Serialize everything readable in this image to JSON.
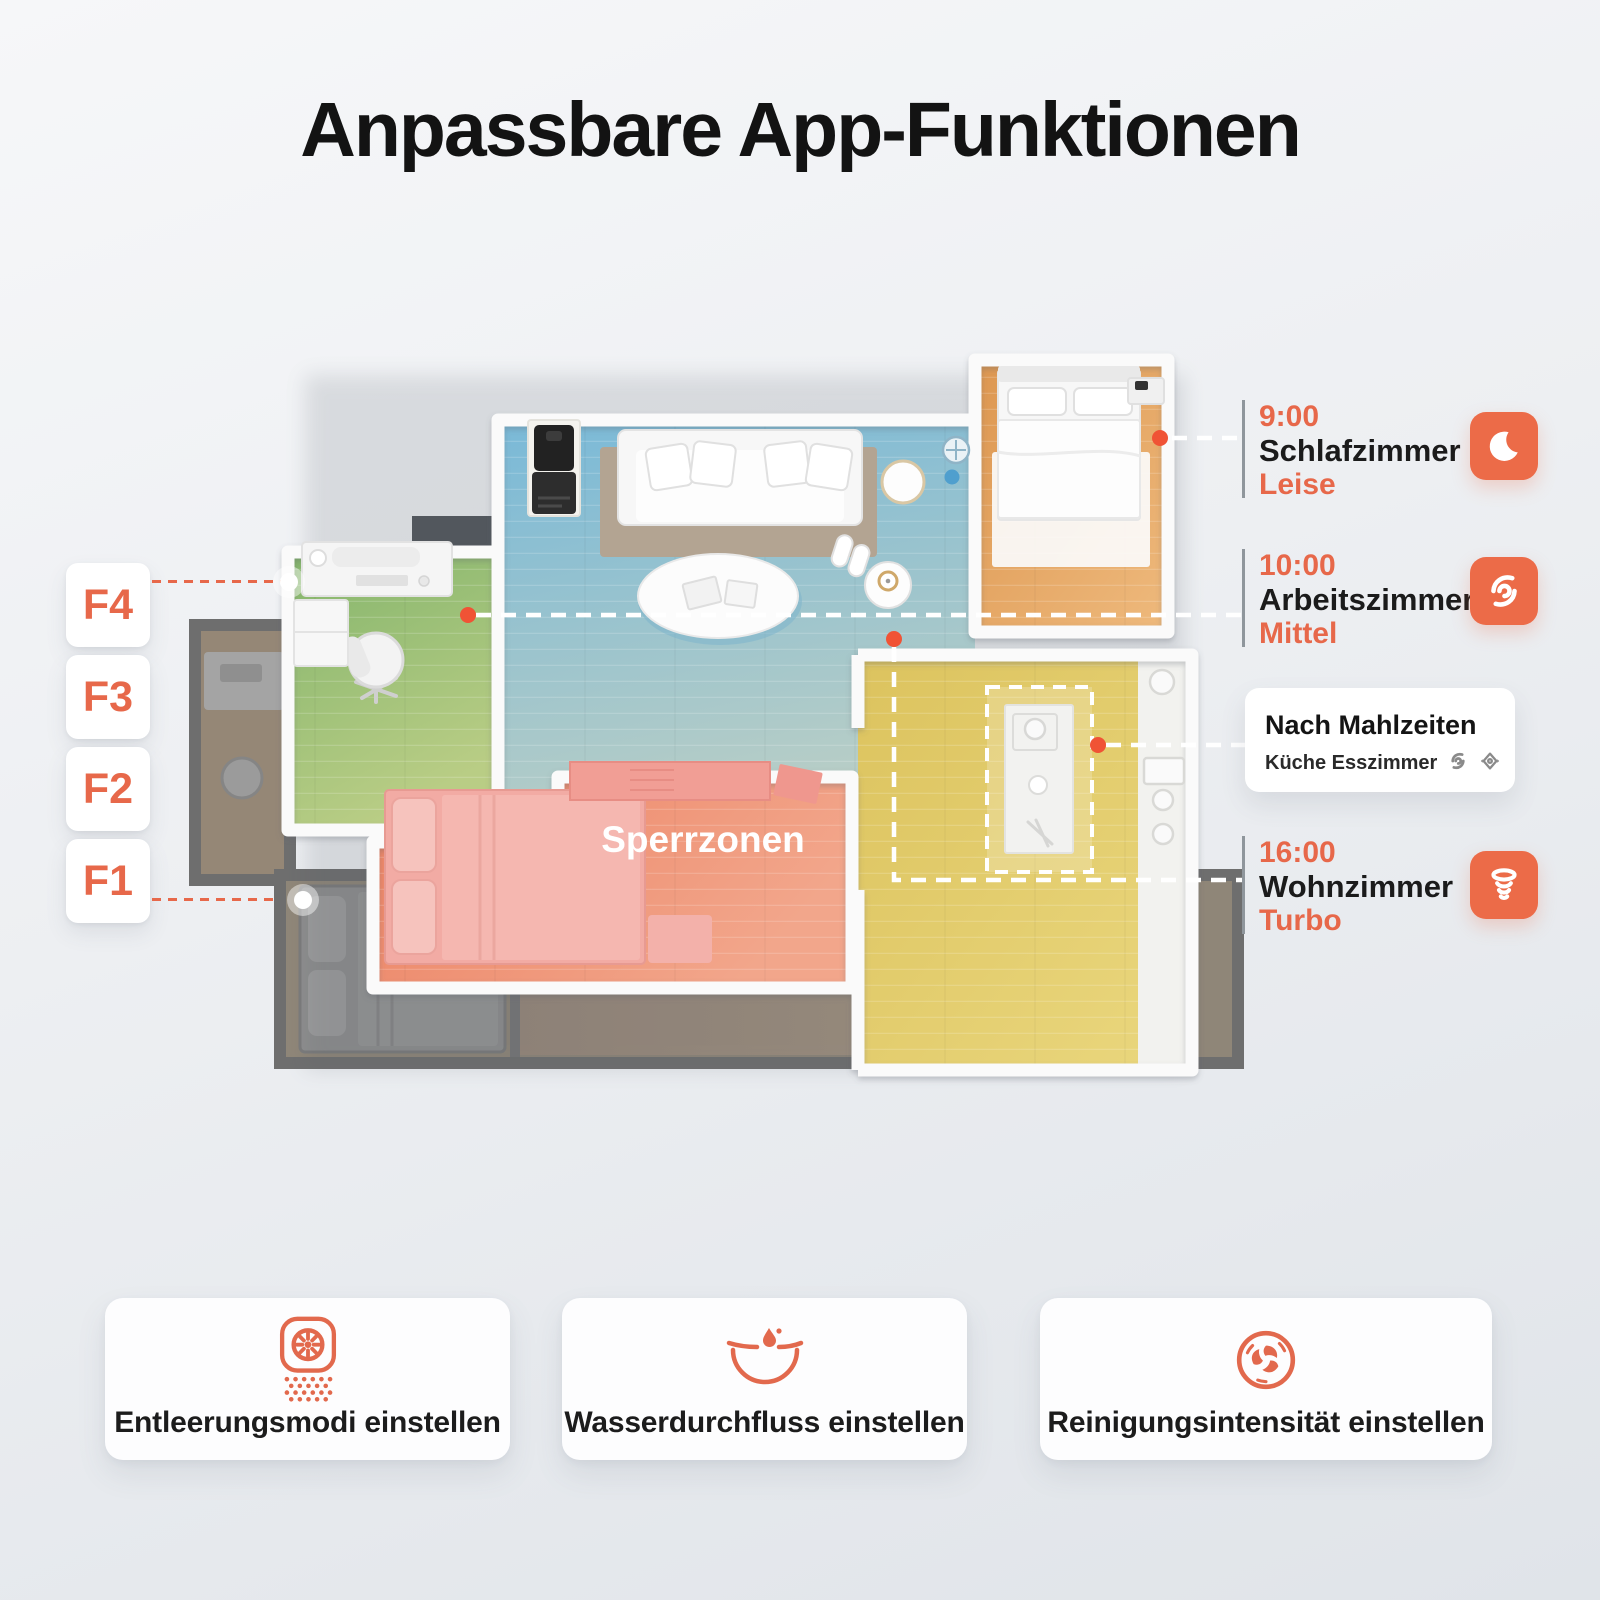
{
  "title": "Anpassbare App-Funktionen",
  "accent_color": "#e7684a",
  "floor_selector": {
    "labels": [
      "F4",
      "F3",
      "F2",
      "F1"
    ]
  },
  "plan": {
    "sperrzonen_label": "Sperrzonen"
  },
  "schedules": [
    {
      "time": "9:00",
      "room": "Schlafzimmer",
      "mode": "Leise",
      "icon": "moon-icon"
    },
    {
      "time": "10:00",
      "room": "Arbeitszimmer",
      "mode": "Mittel",
      "icon": "fan-swirl-icon"
    },
    {
      "time": "16:00",
      "room": "Wohnzimmer",
      "mode": "Turbo",
      "icon": "tornado-icon"
    }
  ],
  "meal_schedule": {
    "title": "Nach Mahlzeiten",
    "rooms": "Küche Esszimmer",
    "icons": [
      "fan-swirl-icon",
      "mop-icon"
    ]
  },
  "feature_cards": [
    {
      "label": "Entleerungsmodi einstellen",
      "icon": "auto-empty-icon"
    },
    {
      "label": "Wasserdurchfluss einstellen",
      "icon": "water-flow-icon"
    },
    {
      "label": "Reinigungsintensität einstellen",
      "icon": "cleaning-intensity-icon"
    }
  ]
}
